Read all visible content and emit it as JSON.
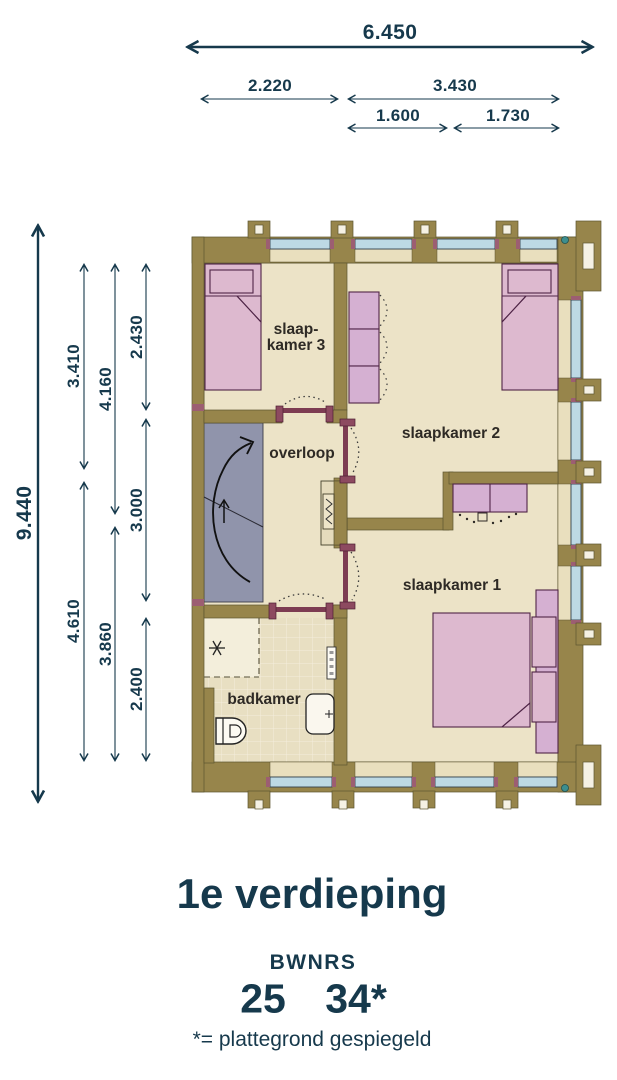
{
  "colors": {
    "wall_olive": "#97854b",
    "floor_beige": "#ece3c7",
    "bed_pink": "#ddb9cf",
    "wardrobe_pink": "#d5b0d2",
    "window_glass": "#bdd9e4",
    "stairs_gray": "#9094ab",
    "door_maroon": "#8d4a60",
    "dimension_navy": "#16394c"
  },
  "dimensions": {
    "width_total": "6.450",
    "width_left": "2.220",
    "width_right": "3.430",
    "width_right_a": "1.600",
    "width_right_b": "1.730",
    "height_total": "9.440",
    "col1_top": "3.410",
    "col1_bottom": "4.610",
    "col2_top": "4.160",
    "col2_bottom": "3.860",
    "col3_top": "2.430",
    "col3_mid": "3.000",
    "col3_bottom": "2.400"
  },
  "rooms": {
    "bedroom3_line1": "slaap-",
    "bedroom3_line2": "kamer 3",
    "bedroom2": "slaapkamer 2",
    "landing": "overloop",
    "bedroom1": "slaapkamer 1",
    "bathroom": "badkamer"
  },
  "footer": {
    "title": "1e verdieping",
    "bwnrs_label": "BWNRS",
    "number_left": "25",
    "number_right": "34*",
    "note": "*= plattegrond gespiegeld"
  }
}
